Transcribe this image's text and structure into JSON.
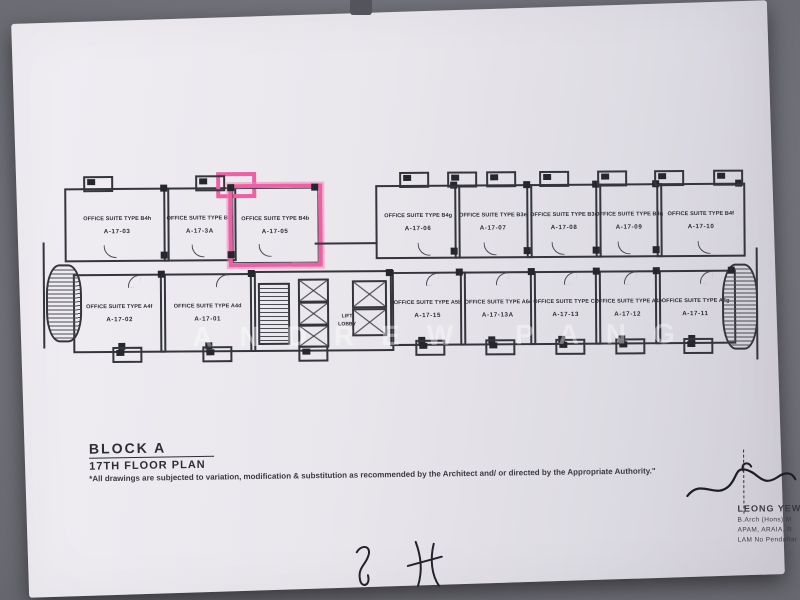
{
  "photo": {
    "background": "#6a6a72",
    "paper": "#e9e7ec",
    "highlight": "#ef5fa4"
  },
  "plan": {
    "units": [
      {
        "label": "OFFICE SUITE TYPE B4h",
        "number": "A-17-03",
        "highlighted": false
      },
      {
        "label": "OFFICE SUITE TYPE B3f",
        "number": "A-17-3A",
        "highlighted": false
      },
      {
        "label": "OFFICE SUITE TYPE B4b",
        "number": "A-17-05",
        "highlighted": true
      },
      {
        "label": "OFFICE SUITE TYPE B4g",
        "number": "A-17-06",
        "highlighted": false
      },
      {
        "label": "OFFICE SUITE TYPE B3e",
        "number": "A-17-07",
        "highlighted": false
      },
      {
        "label": "OFFICE SUITE TYPE B3c",
        "number": "A-17-08",
        "highlighted": false
      },
      {
        "label": "OFFICE SUITE TYPE B3g",
        "number": "A-17-09",
        "highlighted": false
      },
      {
        "label": "OFFICE SUITE TYPE B4f",
        "number": "A-17-10",
        "highlighted": false
      },
      {
        "label": "OFFICE SUITE TYPE A4f",
        "number": "A-17-02",
        "highlighted": false
      },
      {
        "label": "OFFICE SUITE TYPE A4d",
        "number": "A-17-01",
        "highlighted": false
      },
      {
        "label": "OFFICE SUITE TYPE A5b",
        "number": "A-17-15",
        "highlighted": false
      },
      {
        "label": "OFFICE SUITE TYPE A6c",
        "number": "A-17-13A",
        "highlighted": false
      },
      {
        "label": "OFFICE SUITE TYPE C2",
        "number": "A-17-13",
        "highlighted": false
      },
      {
        "label": "OFFICE SUITE TYPE A4e",
        "number": "A-17-12",
        "highlighted": false
      },
      {
        "label": "OFFICE SUITE TYPE A4g",
        "number": "A-17-11",
        "highlighted": false
      }
    ],
    "lift_lobby": {
      "line1": "LIFT",
      "line2": "LOBBY"
    }
  },
  "title_block": {
    "block": "BLOCK A",
    "floor": "17TH FLOOR PLAN",
    "disclaimer": "*All drawings are subjected to variation, modification & substitution as recommended by the Architect and/ or directed by the Appropriate Authority.\""
  },
  "signature": {
    "name": "LEONG YEW K",
    "line2": "B.Arch (Hons) M",
    "line3": "APAM, ARAIA, R",
    "line4": "LAM No Pendaftar"
  },
  "watermark": {
    "text": "ANDREW PANG"
  },
  "handwriting": {
    "mark1": "y",
    "mark2": "4"
  }
}
